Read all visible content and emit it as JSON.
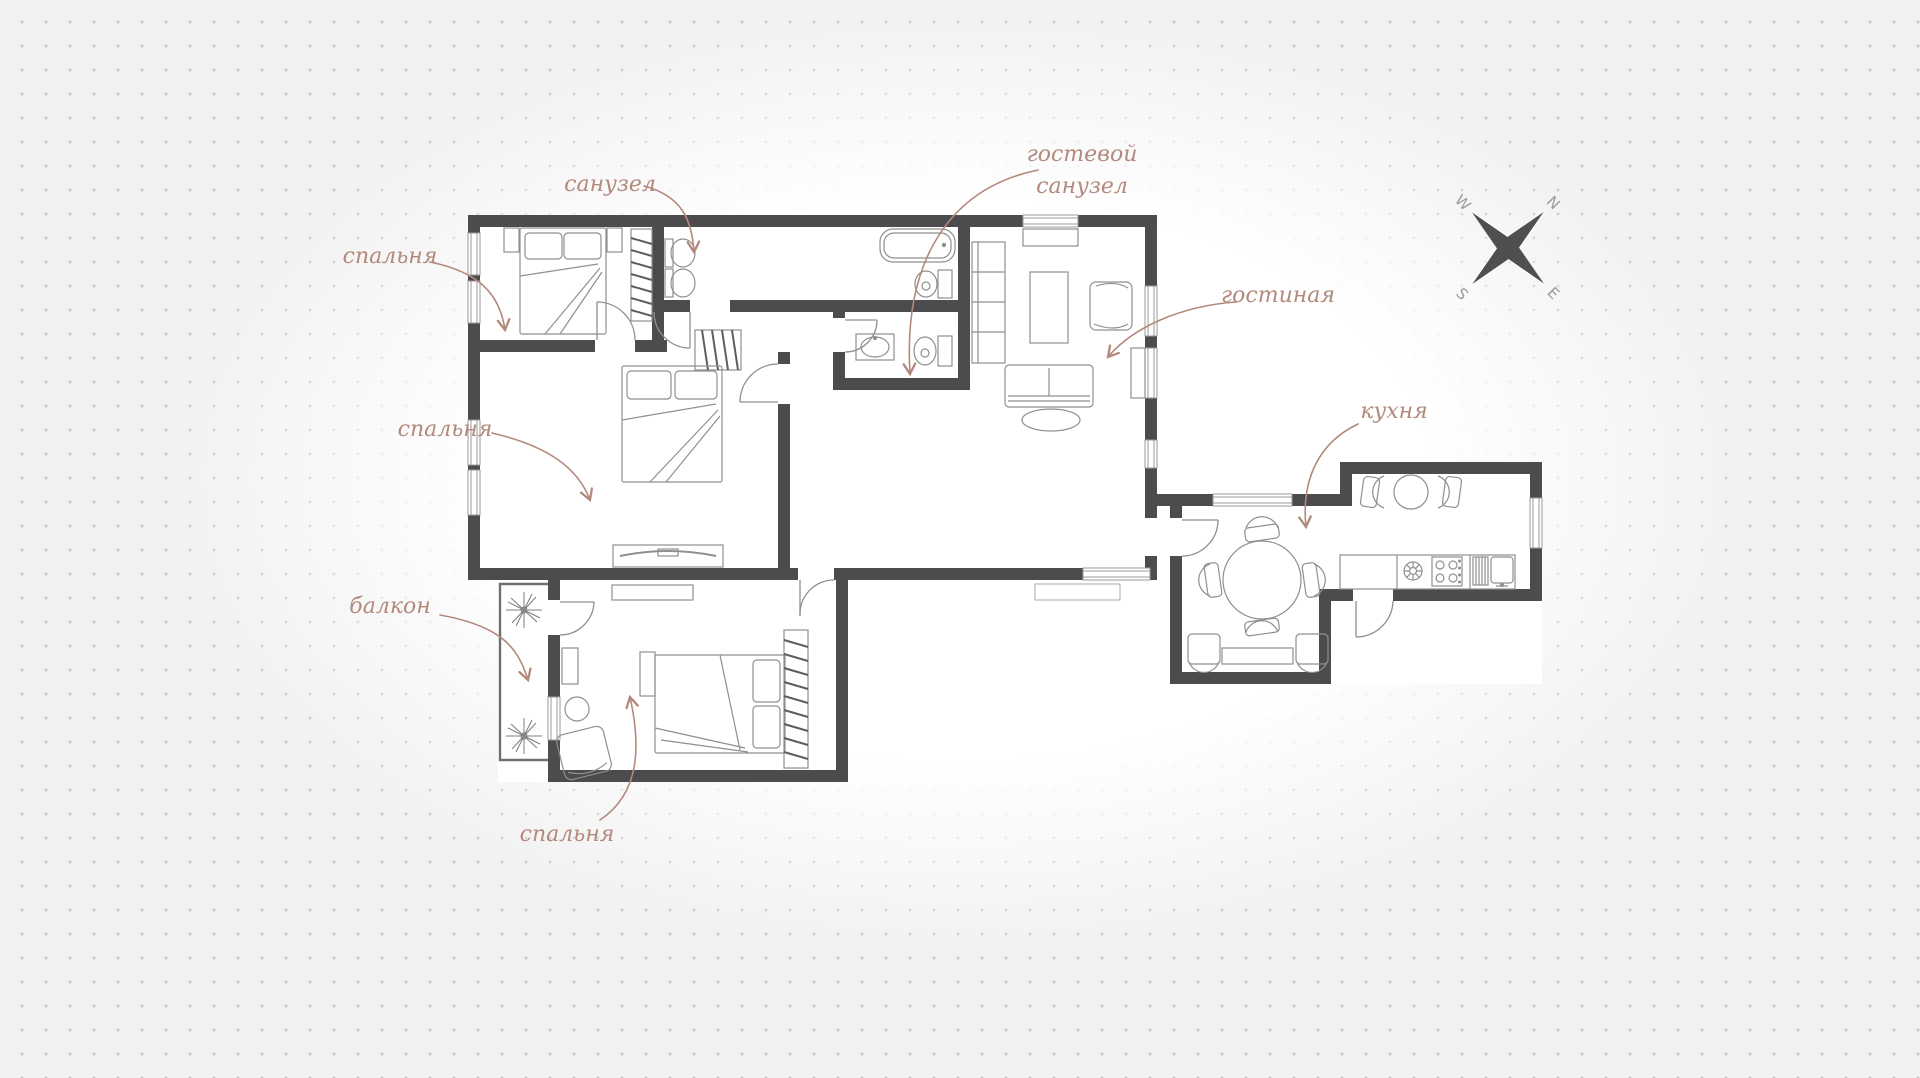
{
  "page": {
    "background_color": "#f1f1f1",
    "dot_color": "#c6c6c6"
  },
  "plan": {
    "wall_color": "#4c4c4e",
    "accent_color": "#b3897c",
    "furniture_color": "#8f8f8f",
    "labels": {
      "bedroom1": "спальня",
      "bathroom": "санузел",
      "guest_bathroom_line1": "гостевой",
      "guest_bathroom_line2": "санузел",
      "living_room": "гостиная",
      "kitchen": "кухня",
      "bedroom2": "спальня",
      "balcony": "балкон",
      "bedroom3": "спальня"
    },
    "compass": {
      "n": "N",
      "e": "E",
      "s": "S",
      "w": "W"
    }
  }
}
